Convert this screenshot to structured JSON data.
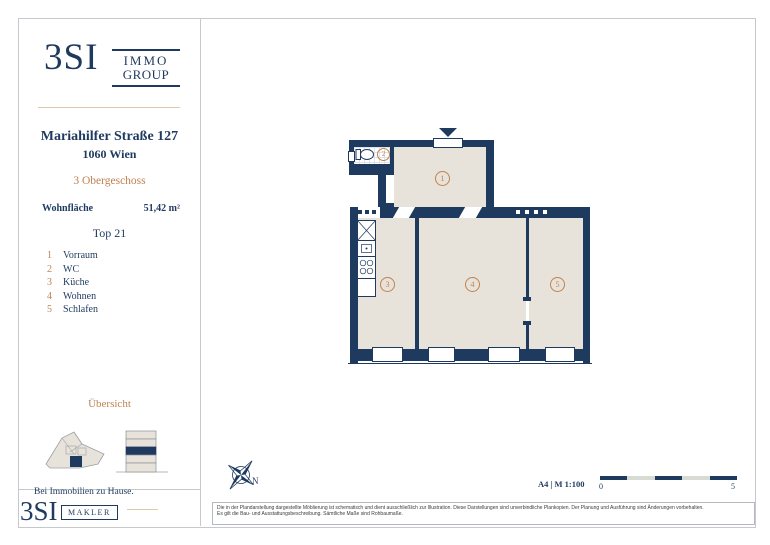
{
  "brand": {
    "logo": "3SI",
    "group_line1": "IMMO",
    "group_line2": "GROUP",
    "makler_logo": "3SI",
    "makler_label": "MAKLER",
    "tagline": "Bei Immobilien zu Hause."
  },
  "property": {
    "street": "Mariahilfer Straße 127",
    "city": "1060 Wien",
    "floor": "3 Obergeschoss",
    "area_label": "Wohnfläche",
    "area_value": "51,42 m²",
    "unit": "Top 21",
    "overview_title": "Übersicht"
  },
  "rooms": [
    {
      "number": "1",
      "name": "Vorraum"
    },
    {
      "number": "2",
      "name": "WC"
    },
    {
      "number": "3",
      "name": "Küche"
    },
    {
      "number": "4",
      "name": "Wohnen"
    },
    {
      "number": "5",
      "name": "Schlafen"
    }
  ],
  "plan": {
    "north_label": "N"
  },
  "footer": {
    "format_scale": "A4 | M 1:100",
    "scale_zero": "0",
    "scale_five": "5",
    "disclaimer_line1": "Die in der Plandarstellung dargestellte Möblierung ist schematisch und dient ausschließlich zur Illustration. Diese Darstellungen sind unverbindliche Plankopien. Der Planung und Ausführung sind Änderungen vorbehalten.",
    "disclaimer_line2": "Es gilt die Bau- und Ausstattungsbeschreibung. Sämtliche Maße sind Rohbaumaße."
  },
  "colors": {
    "navy": "#1f3a5f",
    "room_beige": "#e8e3da",
    "accent_orange": "#c0824f",
    "divider_tan": "#e0c9ab",
    "border_gray": "#c5c9cd"
  }
}
